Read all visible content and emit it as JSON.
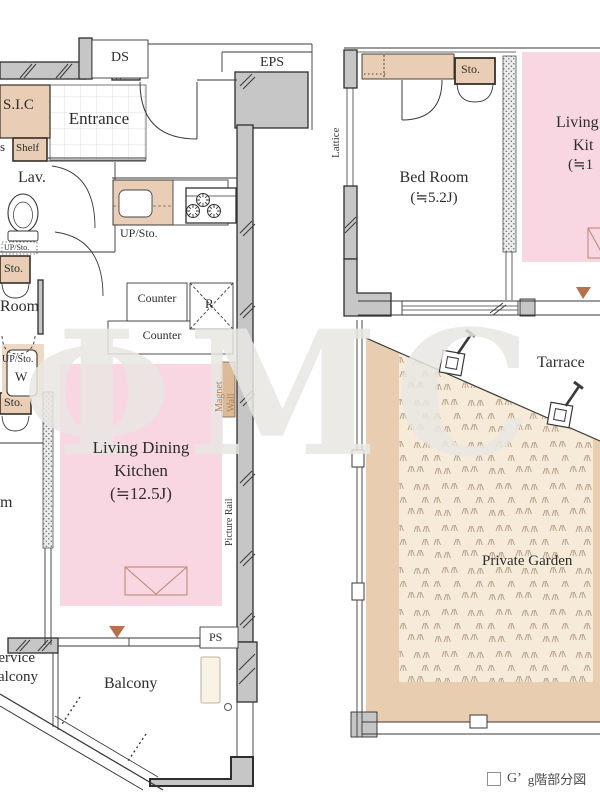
{
  "watermark": "ΦMC",
  "left_plan": {
    "shaft_ds": "DS",
    "shaft_eps": "EPS",
    "shaft_ps": "PS",
    "room_sic": "S.I.C",
    "room_entrance": "Entrance",
    "room_lav": "Lav.",
    "room_cut_top": "Room",
    "room_cut_bottom": "m",
    "ldk_line1": "Living Dining",
    "ldk_line2": "Kitchen",
    "ldk_size": "(≒12.5J)",
    "balcony": "Balcony",
    "service_balcony_line1": "Service",
    "service_balcony_line2": "Balcony",
    "fix_shoes_cut": "s",
    "fix_shelf": "Shelf",
    "fix_up_sto_lav": "UP/Sto.",
    "fix_sto_upper": "Sto.",
    "fix_up_sto_w": "UP/Sto.",
    "fix_washer": "W",
    "fix_sto_lower": "Sto.",
    "fix_up_sto_kitchen": "UP/Sto.",
    "fix_counter_upper": "Counter",
    "fix_counter_lower": "Counter",
    "fix_refrigerator": "R",
    "fix_magnet_line1": "Magnet",
    "fix_magnet_line2": "Wall",
    "fix_picture_rail": "Picture Rail"
  },
  "right_plan": {
    "room_bed": "Bed Room",
    "room_bed_size": "(≒5.2J)",
    "ldk_cut_line1": "Living",
    "ldk_cut_line2": "Kit",
    "ldk_cut_line3": "(≒1",
    "terrace": "Tarrace",
    "garden": "Private Garden",
    "fix_lattice": "Lattice",
    "fix_sto": "Sto."
  },
  "caption": {
    "unit_type": "G’",
    "label": "g階部分図"
  },
  "colors": {
    "ldk_pink": "#f8d7e3",
    "fixture_beige": "#e9cdb4",
    "wall_gray": "#c6c6c6",
    "garden_tan": "#e9cdb0",
    "garden_inner": "#f6ead9",
    "marker_brown": "#b5724a"
  }
}
